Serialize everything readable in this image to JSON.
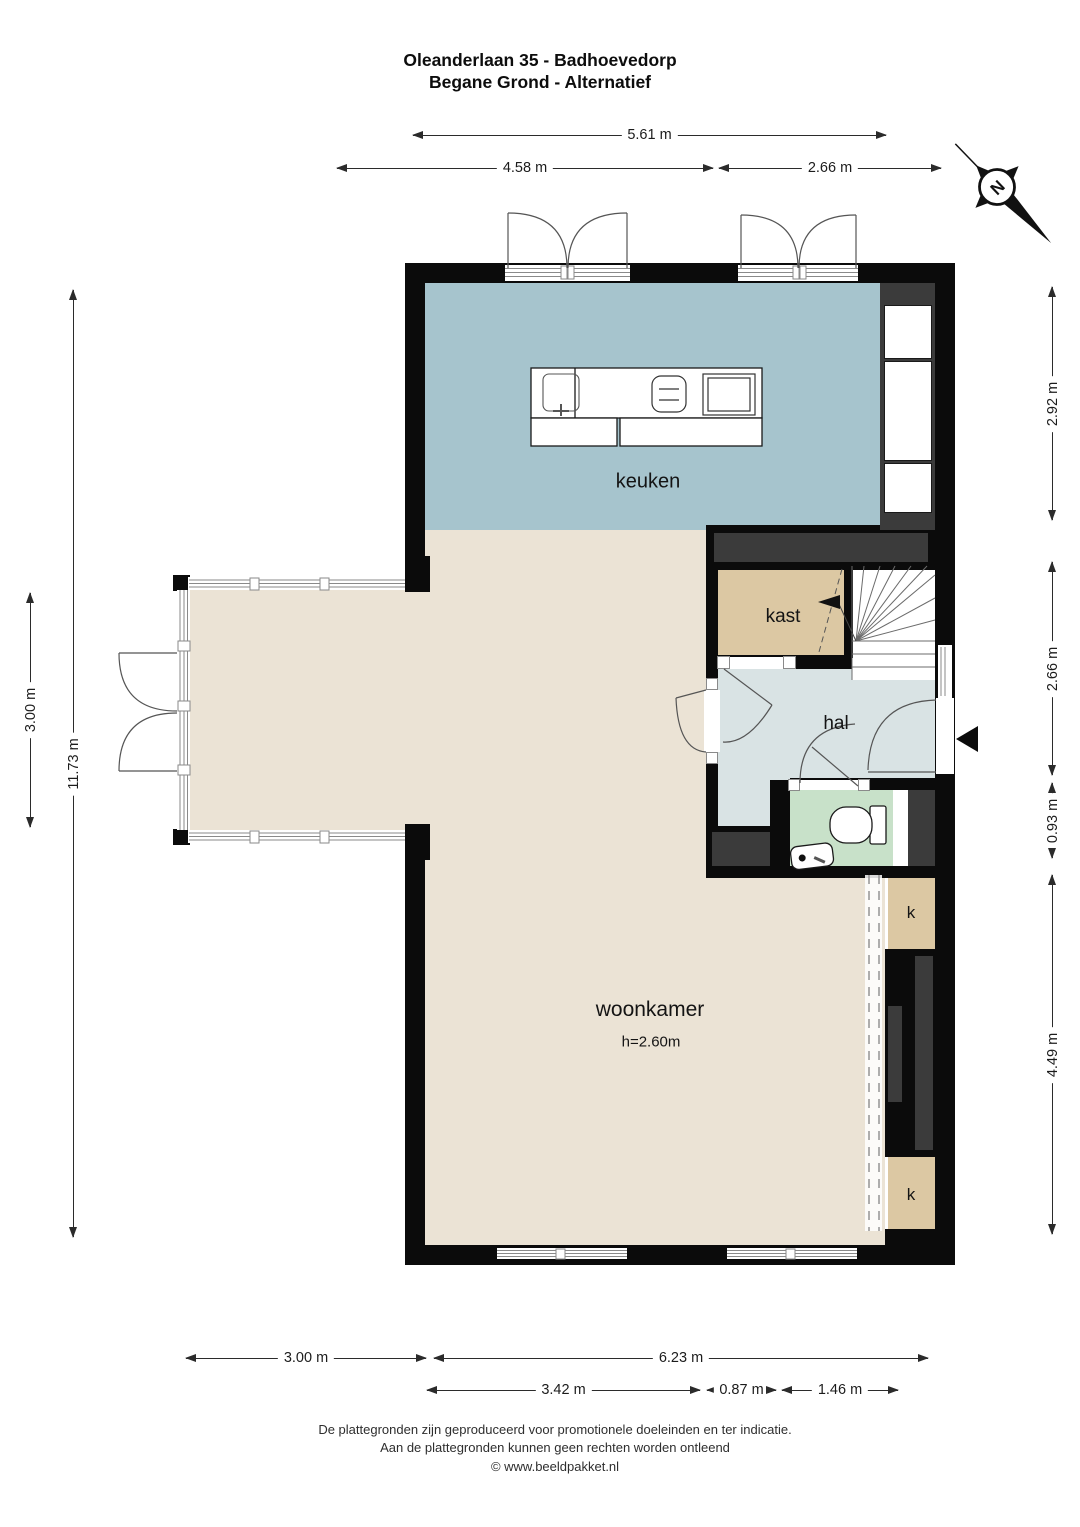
{
  "title": {
    "line1": "Oleanderlaan 35 - Badhoevedorp",
    "line2": "Begane Grond - Alternatief"
  },
  "rooms": {
    "keuken": "keuken",
    "kast": "kast",
    "hal": "hal",
    "woonkamer": "woonkamer",
    "ceiling_height": "h=2.60m",
    "closet": "k"
  },
  "compass": {
    "label": "N"
  },
  "dims": {
    "top_total": "5.61 m",
    "top_left": "4.58 m",
    "top_right": "2.66 m",
    "left_total": "11.73 m",
    "left_upper": "3.00 m",
    "right_kitchen": "2.92 m",
    "right_stairs": "2.66 m",
    "right_door": "0.93 m",
    "right_living": "4.49 m",
    "bottom_left": "3.00 m",
    "bottom_right": "6.23 m",
    "bottom_sub_left": "3.42 m",
    "bottom_sub_mid": "0.87 m",
    "bottom_sub_right": "1.46 m"
  },
  "footer": {
    "line1": "De plattegronden zijn geproduceerd voor promotionele doeleinden en ter indicatie.",
    "line2": "Aan de plattegronden kunnen geen rechten worden ontleend",
    "line3": "© www.beeldpakket.nl"
  },
  "colors": {
    "wall": "#0b0b0b",
    "interior_gray": "#3b3b3b",
    "keuken": "#a6c4cd",
    "woonkamer": "#ebe3d5",
    "kast": "#dcc8a3",
    "hal": "#d9e3e4",
    "toilet": "#c8e1c9"
  }
}
